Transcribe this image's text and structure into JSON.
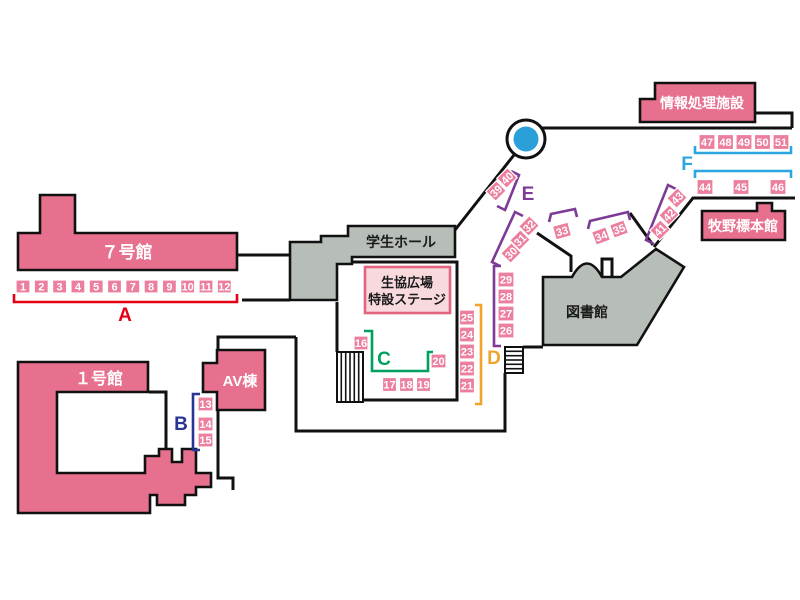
{
  "map": {
    "buildings": [
      {
        "id": "building-7",
        "label": "７号館",
        "type": "pink"
      },
      {
        "id": "building-1",
        "label": "１号館",
        "type": "pink"
      },
      {
        "id": "av-building",
        "label": "AV棟",
        "type": "pink"
      },
      {
        "id": "student-hall",
        "label": "学生ホール",
        "type": "gray"
      },
      {
        "id": "library",
        "label": "図書館",
        "type": "gray"
      },
      {
        "id": "info-processing",
        "label": "情報処理施設",
        "type": "pink"
      },
      {
        "id": "makino-herbarium",
        "label": "牧野標本館",
        "type": "pink"
      }
    ],
    "stage": {
      "line1": "生協広場",
      "line2": "特設ステージ"
    },
    "groups": [
      {
        "label": "A",
        "color": "#e60014"
      },
      {
        "label": "B",
        "color": "#283593"
      },
      {
        "label": "C",
        "color": "#00a05e"
      },
      {
        "label": "D",
        "color": "#efa32a"
      },
      {
        "label": "E",
        "color": "#7d3a96"
      },
      {
        "label": "F",
        "color": "#2ca6e0"
      }
    ],
    "booths": [
      "1",
      "2",
      "3",
      "4",
      "5",
      "6",
      "7",
      "8",
      "9",
      "10",
      "11",
      "12",
      "13",
      "14",
      "15",
      "16",
      "17",
      "18",
      "19",
      "20",
      "21",
      "22",
      "23",
      "24",
      "25",
      "26",
      "27",
      "28",
      "29",
      "30",
      "31",
      "32",
      "33",
      "34",
      "35",
      "39",
      "40",
      "41",
      "42",
      "43",
      "44",
      "45",
      "46",
      "47",
      "48",
      "49",
      "50",
      "51"
    ],
    "colors": {
      "building_pink": "#e8708f",
      "booth_pink": "#eb7f9d",
      "booth_border": "#ffffff",
      "building_gray": "#b7beb8",
      "stage_fill": "#f8dade",
      "stage_border": "#e2647f",
      "path": "#111111",
      "pond_blue": "#2b9fd8"
    }
  }
}
